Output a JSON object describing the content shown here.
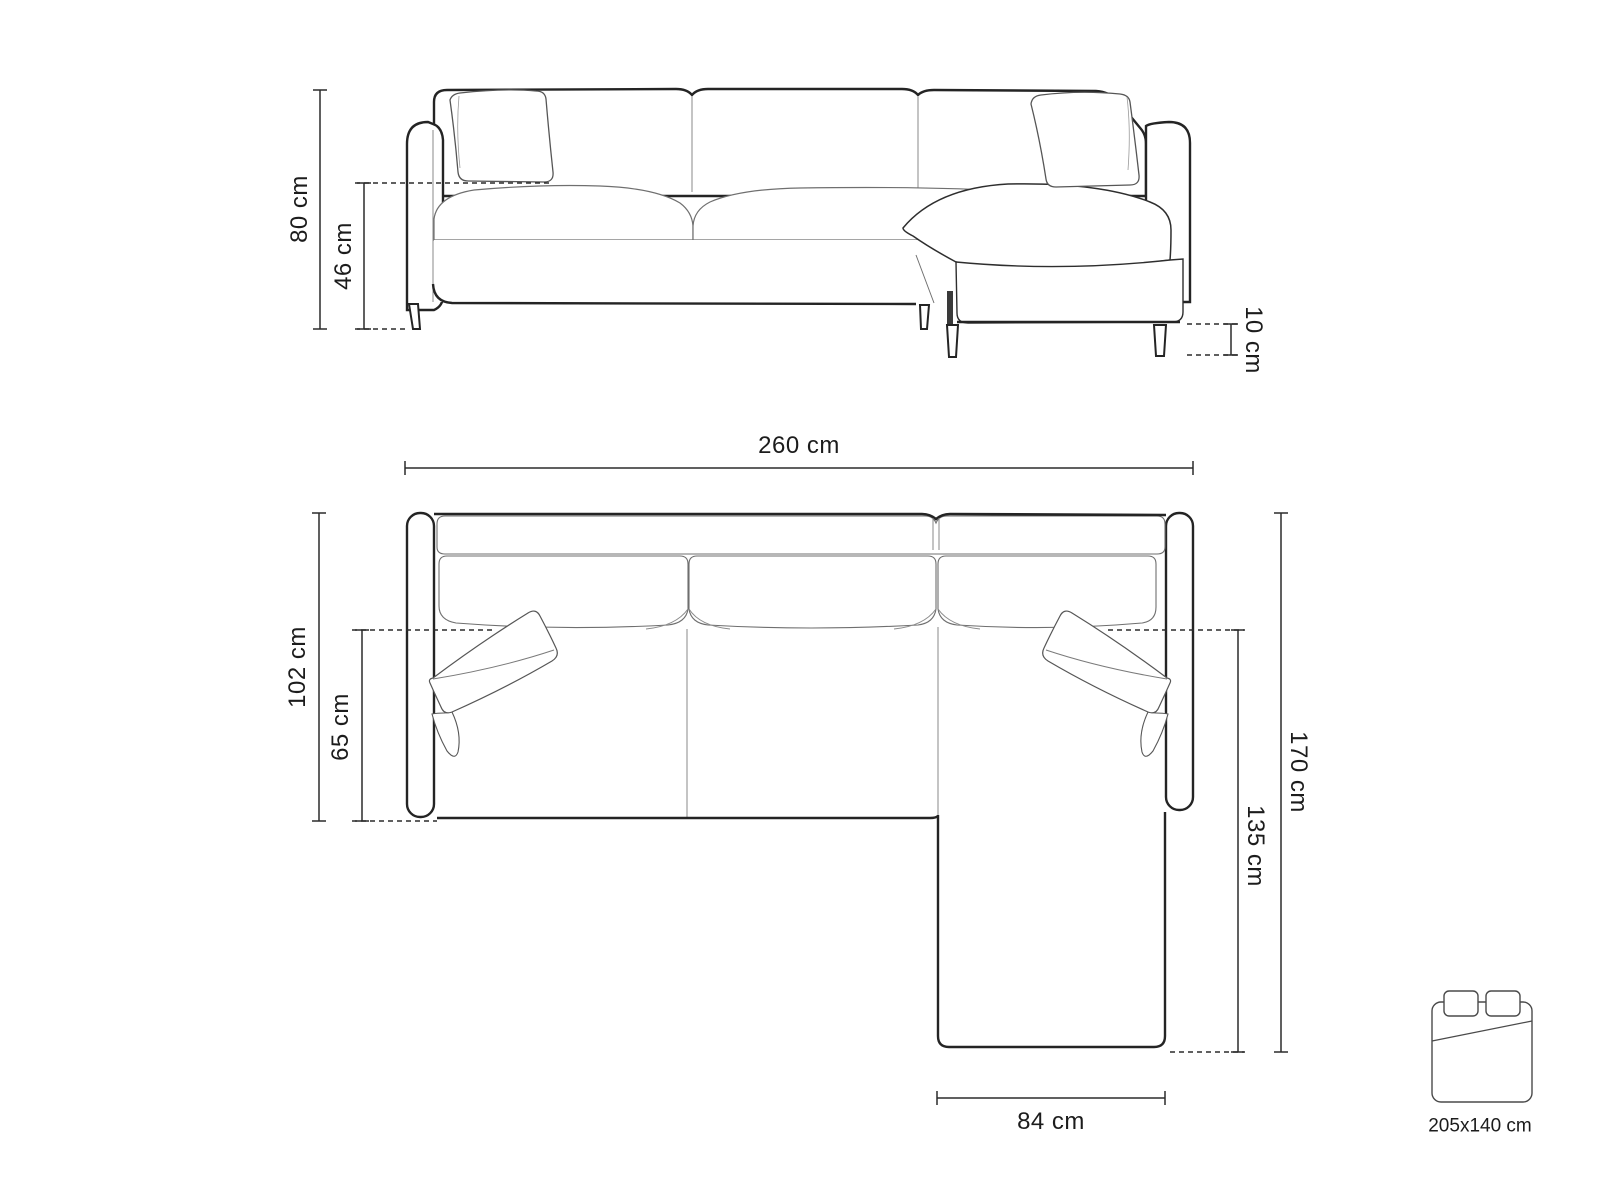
{
  "diagram": {
    "front_view": {
      "dims": {
        "height": "80 cm",
        "seat_height": "46 cm",
        "leg_height": "10 cm"
      }
    },
    "top_view": {
      "dims": {
        "width": "260 cm",
        "depth": "102 cm",
        "seat_depth": "65 cm",
        "total_depth": "170 cm",
        "chaise_length": "135 cm",
        "chaise_width": "84 cm"
      }
    },
    "sleeping_area": {
      "icon": "bed-icon",
      "label": "205x140 cm"
    },
    "colors": {
      "outline": "#242424",
      "seam": "#7a7a7a",
      "dimension": "#2b2b2b",
      "text": "#1c1c1c",
      "background": "#ffffff"
    }
  }
}
